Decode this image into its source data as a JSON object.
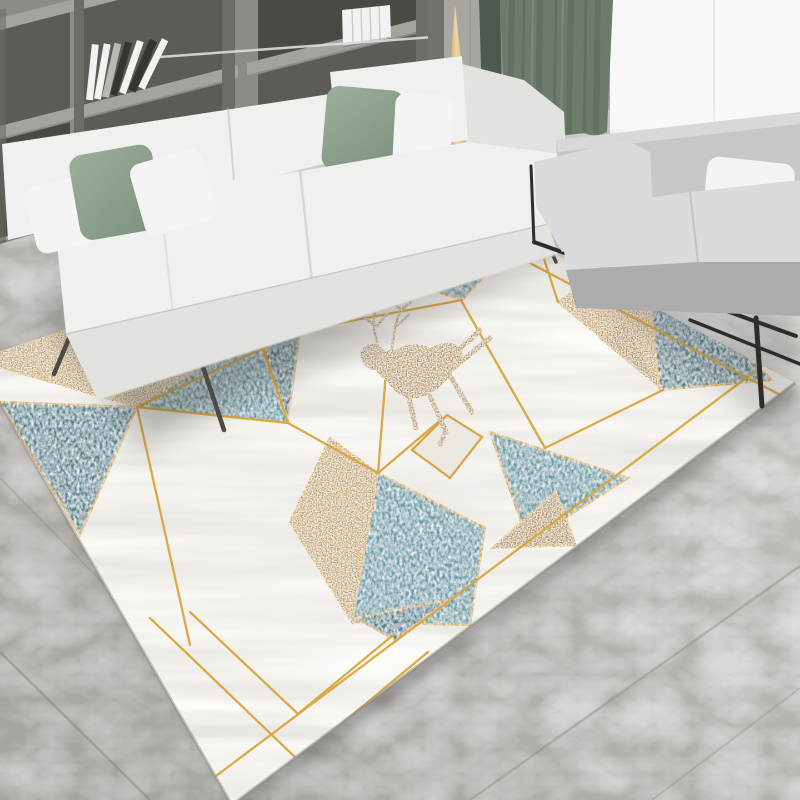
{
  "scene": {
    "type": "product-photo",
    "description": "Modern living room with a geometric deer-motif area rug, white fabric sofa, gray loveseat, wood bookshelf wall, gold cone floor lamp, sage curtain, bright window and gray marble tile floor",
    "objects": [
      "bookshelf-wall-unit",
      "decor-books",
      "metal-ladder",
      "wood-wall-panels",
      "gold-cone-floor-lamp",
      "sage-curtain",
      "window",
      "white-sofa",
      "sage-cushions",
      "white-cushions",
      "gray-loveseat",
      "white-throw-pillow",
      "black-metal-frame",
      "marble-floor",
      "geometric-rug",
      "deer-motif",
      "gold-glitter-triangles",
      "teal-shag-triangles",
      "white-marble-triangles",
      "gold-dividing-lines"
    ]
  },
  "rug": {
    "style": "geometric triangles: white marble, teal shag, gold glitter, thin gold lines",
    "motif": "leaping gold deer",
    "shape": "rectangle in perspective"
  },
  "palette": {
    "wall_wood": "#8d8b86",
    "wall_wood_dark": "#6e6c67",
    "shelf_cavity": "#5d5b56",
    "shelf_cavity_dark": "#4a4944",
    "shelf_board": "#a5a39e",
    "panel_light": "#a8a6a1",
    "panel_seam": "#8f8d88",
    "book_white": "#f2f2f0",
    "book_dark": "#35352f",
    "book_gray": "#b9b9b4",
    "metal_light": "#dcdddd",
    "lamp_gold_dark": "#8f6c33",
    "lamp_gold_light": "#eed7a4",
    "lamp_gold_mid": "#c09a55",
    "curtain_main": "#6d7a6c",
    "curtain_dark": "#57645a",
    "curtain_side": "#4e5a50",
    "curtain_hi": "#8a9689",
    "window_white": "#f8f8f6",
    "floor_light": "#dedcd8",
    "floor_mid": "#b6b3af",
    "floor_dark": "#9b9793",
    "floor_seam": "#87847f",
    "sofa_white_top": "#f0f0ee",
    "sofa_white_front": "#e2e2df",
    "sofa_white_skirt": "#cfcfca",
    "sofa_crease": "#b9b9b4",
    "pillow_white": "#f4f4f2",
    "pillow_sage_light": "#9cae9d",
    "pillow_sage_dark": "#7e937f",
    "loveseat_light": "#d9dbdc",
    "loveseat_mid": "#c5c7c8",
    "loveseat_dark": "#aaacae",
    "frame_black": "#2c2d2e",
    "leg_dark": "#4b4a47",
    "chrome": "#97979a",
    "rug_white": "#ebe8e2",
    "rug_white_shade": "#dcd9d2",
    "rug_teal": "#6a9ba6",
    "rug_teal_deep": "#54818d",
    "rug_glitter": "#c4a068",
    "rug_glitter_deep": "#ad8a52",
    "rug_gold_line": "#d8a63e",
    "rug_edge": "#8a877f",
    "deer_gold": "#b3905f",
    "shadow": "#3c3b38"
  }
}
